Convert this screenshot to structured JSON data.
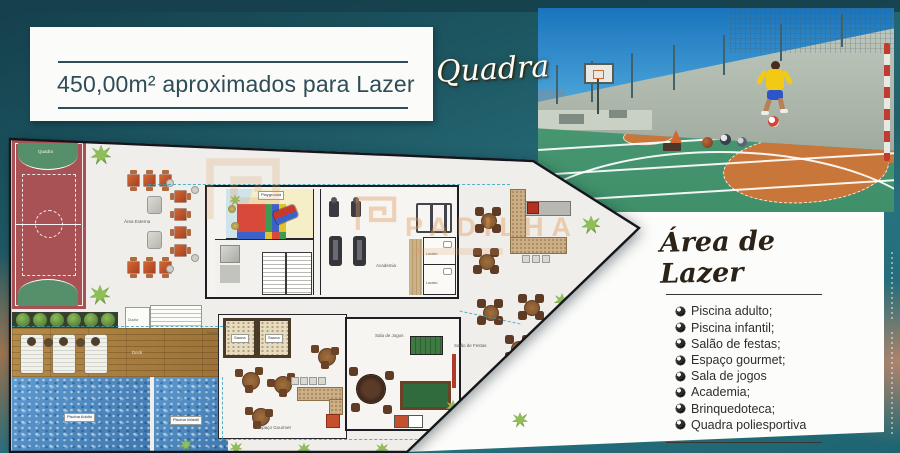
{
  "header": {
    "area_card_text": "450,00m² aproximados para Lazer",
    "photo_title_script": "Quadra"
  },
  "amenities": {
    "title": "Área de Lazer",
    "items": [
      "Piscina adulto;",
      "Piscina infantil;",
      "Salão de festas;",
      "Espaço gourmet;",
      "Sala de jogos",
      "Academia;",
      "Brinquedoteca;",
      "Quadra poliesportiva"
    ]
  },
  "plan_labels": {
    "quadra": "Quadra",
    "playground": "Playground",
    "academia": "Academia",
    "sauna": "Sauna",
    "ducha": "Ducha",
    "espaco_gourmet": "Espaço Gourmet",
    "sala_de_jogos": "Sala de Jogos",
    "salao_de_festas": "Salão de Festas",
    "piscina_adulto": "Piscina Adulto",
    "piscina_infantil": "Piscina Infantil",
    "deck": "Deck",
    "area_externa": "Área Externa",
    "lavabo": "Lavabo"
  },
  "watermark": {
    "text": "PADILHA"
  },
  "colors": {
    "background_teal": "#1d5863",
    "accent_orange": "#c98b5e",
    "court_red": "#a85256",
    "court_green": "#55906b",
    "pool_blue": "#5e9bd0",
    "plan_white": "#efeeea"
  }
}
